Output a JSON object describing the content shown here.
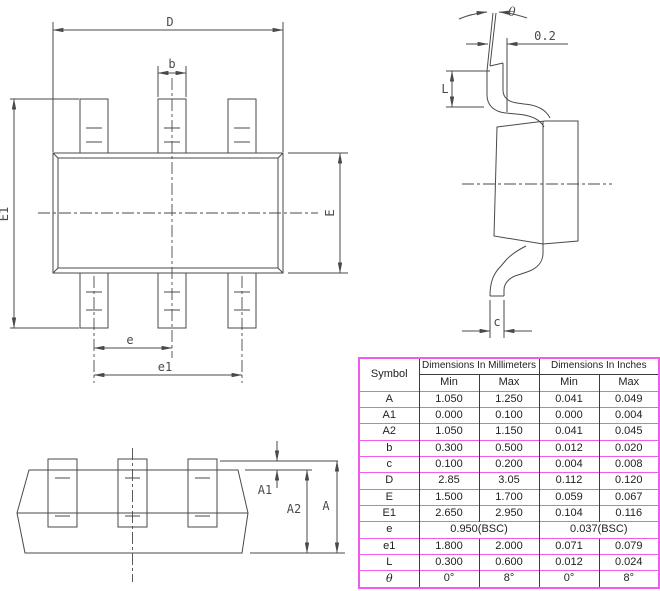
{
  "drawing": {
    "top_view": {
      "d": "D",
      "b": "b",
      "e1_width": "E1",
      "e_width": "E",
      "e_pitch": "e",
      "e1_pitch": "e1"
    },
    "side_view": {
      "theta": "θ",
      "tip_offset": "0.2",
      "foot_length": "L",
      "lead_thickness": "c"
    },
    "front_view": {
      "a1": "A1",
      "a2": "A2",
      "a": "A"
    }
  },
  "table": {
    "header": {
      "symbol": "Symbol",
      "mm_group": "Dimensions In Millimeters",
      "in_group": "Dimensions In Inches",
      "min": "Min",
      "max": "Max"
    },
    "rows": [
      {
        "symbol": "A",
        "mm_min": "1.050",
        "mm_max": "1.250",
        "in_min": "0.041",
        "in_max": "0.049"
      },
      {
        "symbol": "A1",
        "mm_min": "0.000",
        "mm_max": "0.100",
        "in_min": "0.000",
        "in_max": "0.004"
      },
      {
        "symbol": "A2",
        "mm_min": "1.050",
        "mm_max": "1.150",
        "in_min": "0.041",
        "in_max": "0.045"
      },
      {
        "symbol": "b",
        "mm_min": "0.300",
        "mm_max": "0.500",
        "in_min": "0.012",
        "in_max": "0.020"
      },
      {
        "symbol": "c",
        "mm_min": "0.100",
        "mm_max": "0.200",
        "in_min": "0.004",
        "in_max": "0.008"
      },
      {
        "symbol": "D",
        "mm_min": "2.85",
        "mm_max": "3.05",
        "in_min": "0.112",
        "in_max": "0.120"
      },
      {
        "symbol": "E",
        "mm_min": "1.500",
        "mm_max": "1.700",
        "in_min": "0.059",
        "in_max": "0.067"
      },
      {
        "symbol": "E1",
        "mm_min": "2.650",
        "mm_max": "2.950",
        "in_min": "0.104",
        "in_max": "0.116"
      },
      {
        "symbol": "e",
        "mm_value": "0.950(BSC)",
        "in_value": "0.037(BSC)"
      },
      {
        "symbol": "e1",
        "mm_min": "1.800",
        "mm_max": "2.000",
        "in_min": "0.071",
        "in_max": "0.079"
      },
      {
        "symbol": "L",
        "mm_min": "0.300",
        "mm_max": "0.600",
        "in_min": "0.012",
        "in_max": "0.024"
      },
      {
        "symbol": "θ",
        "mm_min": "0°",
        "mm_max": "8°",
        "in_min": "0°",
        "in_max": "8°"
      }
    ]
  },
  "colors": {
    "table_border": "#ee5cee",
    "drawing_line": "#4a4a4a"
  }
}
